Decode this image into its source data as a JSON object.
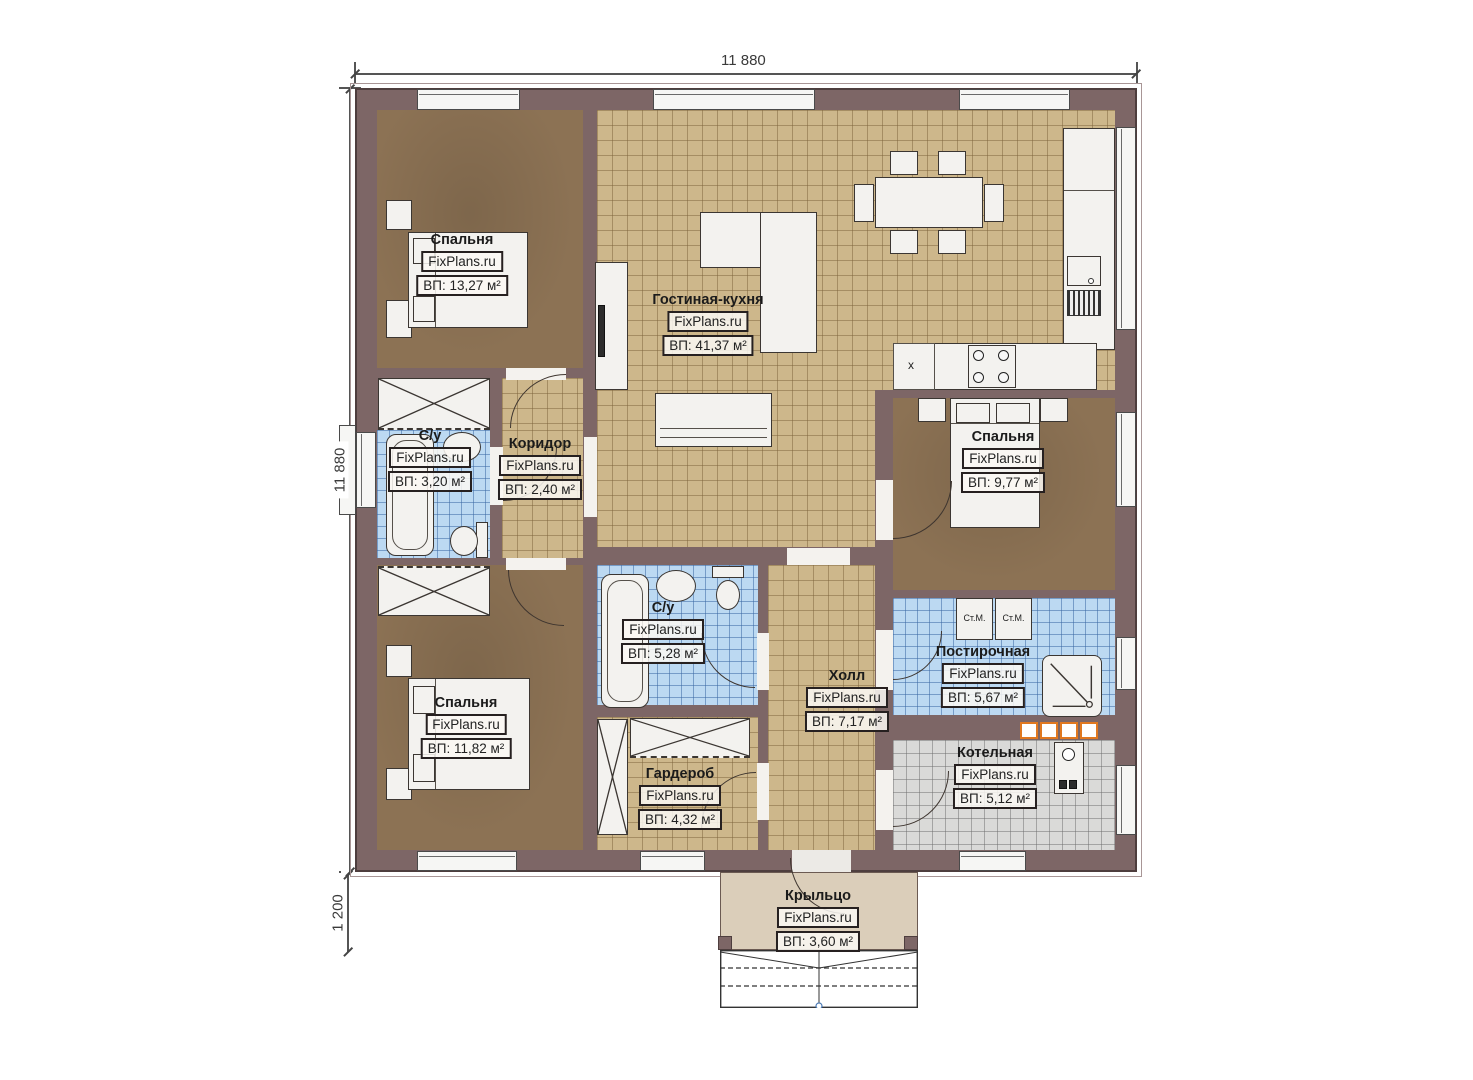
{
  "watermark": "FixPlans.ru",
  "dimensions": {
    "top": "11 880",
    "left": "11 880",
    "porch": "1 200"
  },
  "rooms": {
    "bedroom1": {
      "name": "Спальня",
      "area": "ВП: 13,27 м²"
    },
    "living": {
      "name": "Гостиная-кухня",
      "area": "ВП: 41,37 м²"
    },
    "bath1": {
      "name": "С/у",
      "area": "ВП: 3,20 м²"
    },
    "corridor": {
      "name": "Коридор",
      "area": "ВП: 2,40 м²"
    },
    "bedroom2": {
      "name": "Спальня",
      "area": "ВП: 9,77 м²"
    },
    "bath2": {
      "name": "С/у",
      "area": "ВП: 5,28 м²"
    },
    "hall": {
      "name": "Холл",
      "area": "ВП: 7,17 м²"
    },
    "laundry": {
      "name": "Постирочная",
      "area": "ВП: 5,67 м²"
    },
    "boiler_room": {
      "name": "Котельная",
      "area": "ВП: 5,12 м²"
    },
    "bedroom3": {
      "name": "Спальня",
      "area": "ВП: 11,82 м²"
    },
    "wardrobe": {
      "name": "Гардероб",
      "area": "ВП: 4,32 м²"
    },
    "porch": {
      "name": "Крыльцо",
      "area": "ВП: 3,60 м²"
    }
  },
  "appliances": {
    "washing_machine": "Ст.М.",
    "sink_unit_marker": "x"
  }
}
